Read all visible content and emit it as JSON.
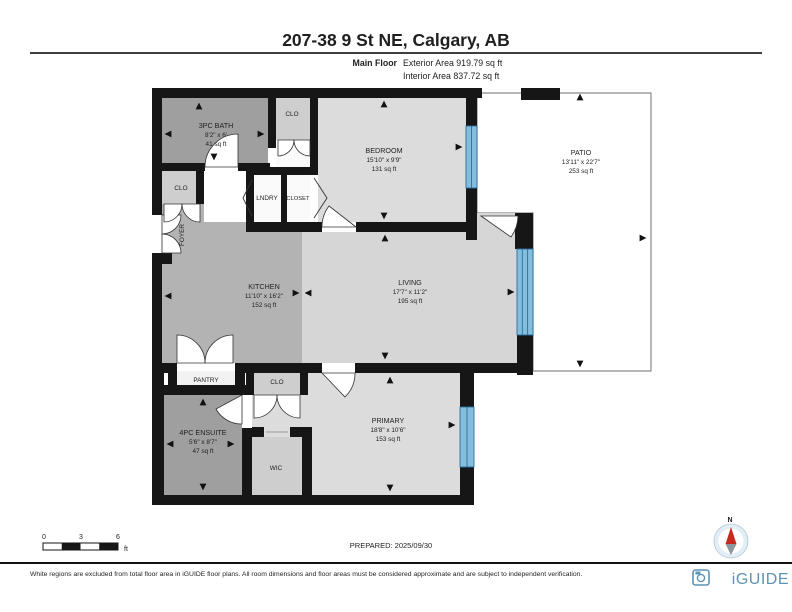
{
  "header": {
    "title": "207-38 9 St NE, Calgary, AB",
    "floor_label": "Main Floor",
    "exterior_area": "Exterior Area 919.79 sq ft",
    "interior_area": "Interior Area 837.72 sq ft"
  },
  "rooms": {
    "bath": {
      "name": "3PC BATH",
      "dims": "8'2\" x 6'",
      "area": "41 sq ft"
    },
    "clo_top": {
      "name": "CLO"
    },
    "bedroom": {
      "name": "BEDROOM",
      "dims": "15'10\" x 9'9\"",
      "area": "131 sq ft"
    },
    "patio": {
      "name": "PATIO",
      "dims": "13'11\" x 22'7\"",
      "area": "253 sq ft"
    },
    "clo_left": {
      "name": "CLO"
    },
    "lndry": {
      "name": "LNDRY"
    },
    "closet": {
      "name": "CLOSET"
    },
    "foyer": {
      "name": "FOYER"
    },
    "kitchen": {
      "name": "KITCHEN",
      "dims": "11'10\" x 16'2\"",
      "area": "152 sq ft"
    },
    "living": {
      "name": "LIVING",
      "dims": "17'7\" x 11'2\"",
      "area": "195 sq ft"
    },
    "pantry": {
      "name": "PANTRY"
    },
    "clo_mid": {
      "name": "CLO"
    },
    "ensuite": {
      "name": "4PC ENSUITE",
      "dims": "5'6\" x 8'7\"",
      "area": "47 sq ft"
    },
    "wic": {
      "name": "WIC"
    },
    "primary": {
      "name": "PRIMARY",
      "dims": "18'8\" x 10'6\"",
      "area": "153 sq ft"
    }
  },
  "scale_bar": {
    "tick0": "0",
    "tick1": "3",
    "tick2": "6",
    "unit": "ft"
  },
  "prepared": "PREPARED: 2025/09/30",
  "compass": {
    "north_label": "N"
  },
  "footer": {
    "disclaimer": "White regions are excluded from total floor area in iGUIDE floor plans. All room dimensions and floor areas must be considered approximate and are subject to independent verification.",
    "brand": "iGUIDE"
  },
  "colors": {
    "wall": "#161616",
    "room_dark": "#9f9f9f",
    "room_mid": "#b3b3b3",
    "room_light": "#dcdcdc",
    "closet": "#cecece",
    "window_blue": "#85bedd",
    "window_frame": "#2a6f9e",
    "brand_blue": "#5b94b4",
    "compass_red": "#c8281e"
  }
}
